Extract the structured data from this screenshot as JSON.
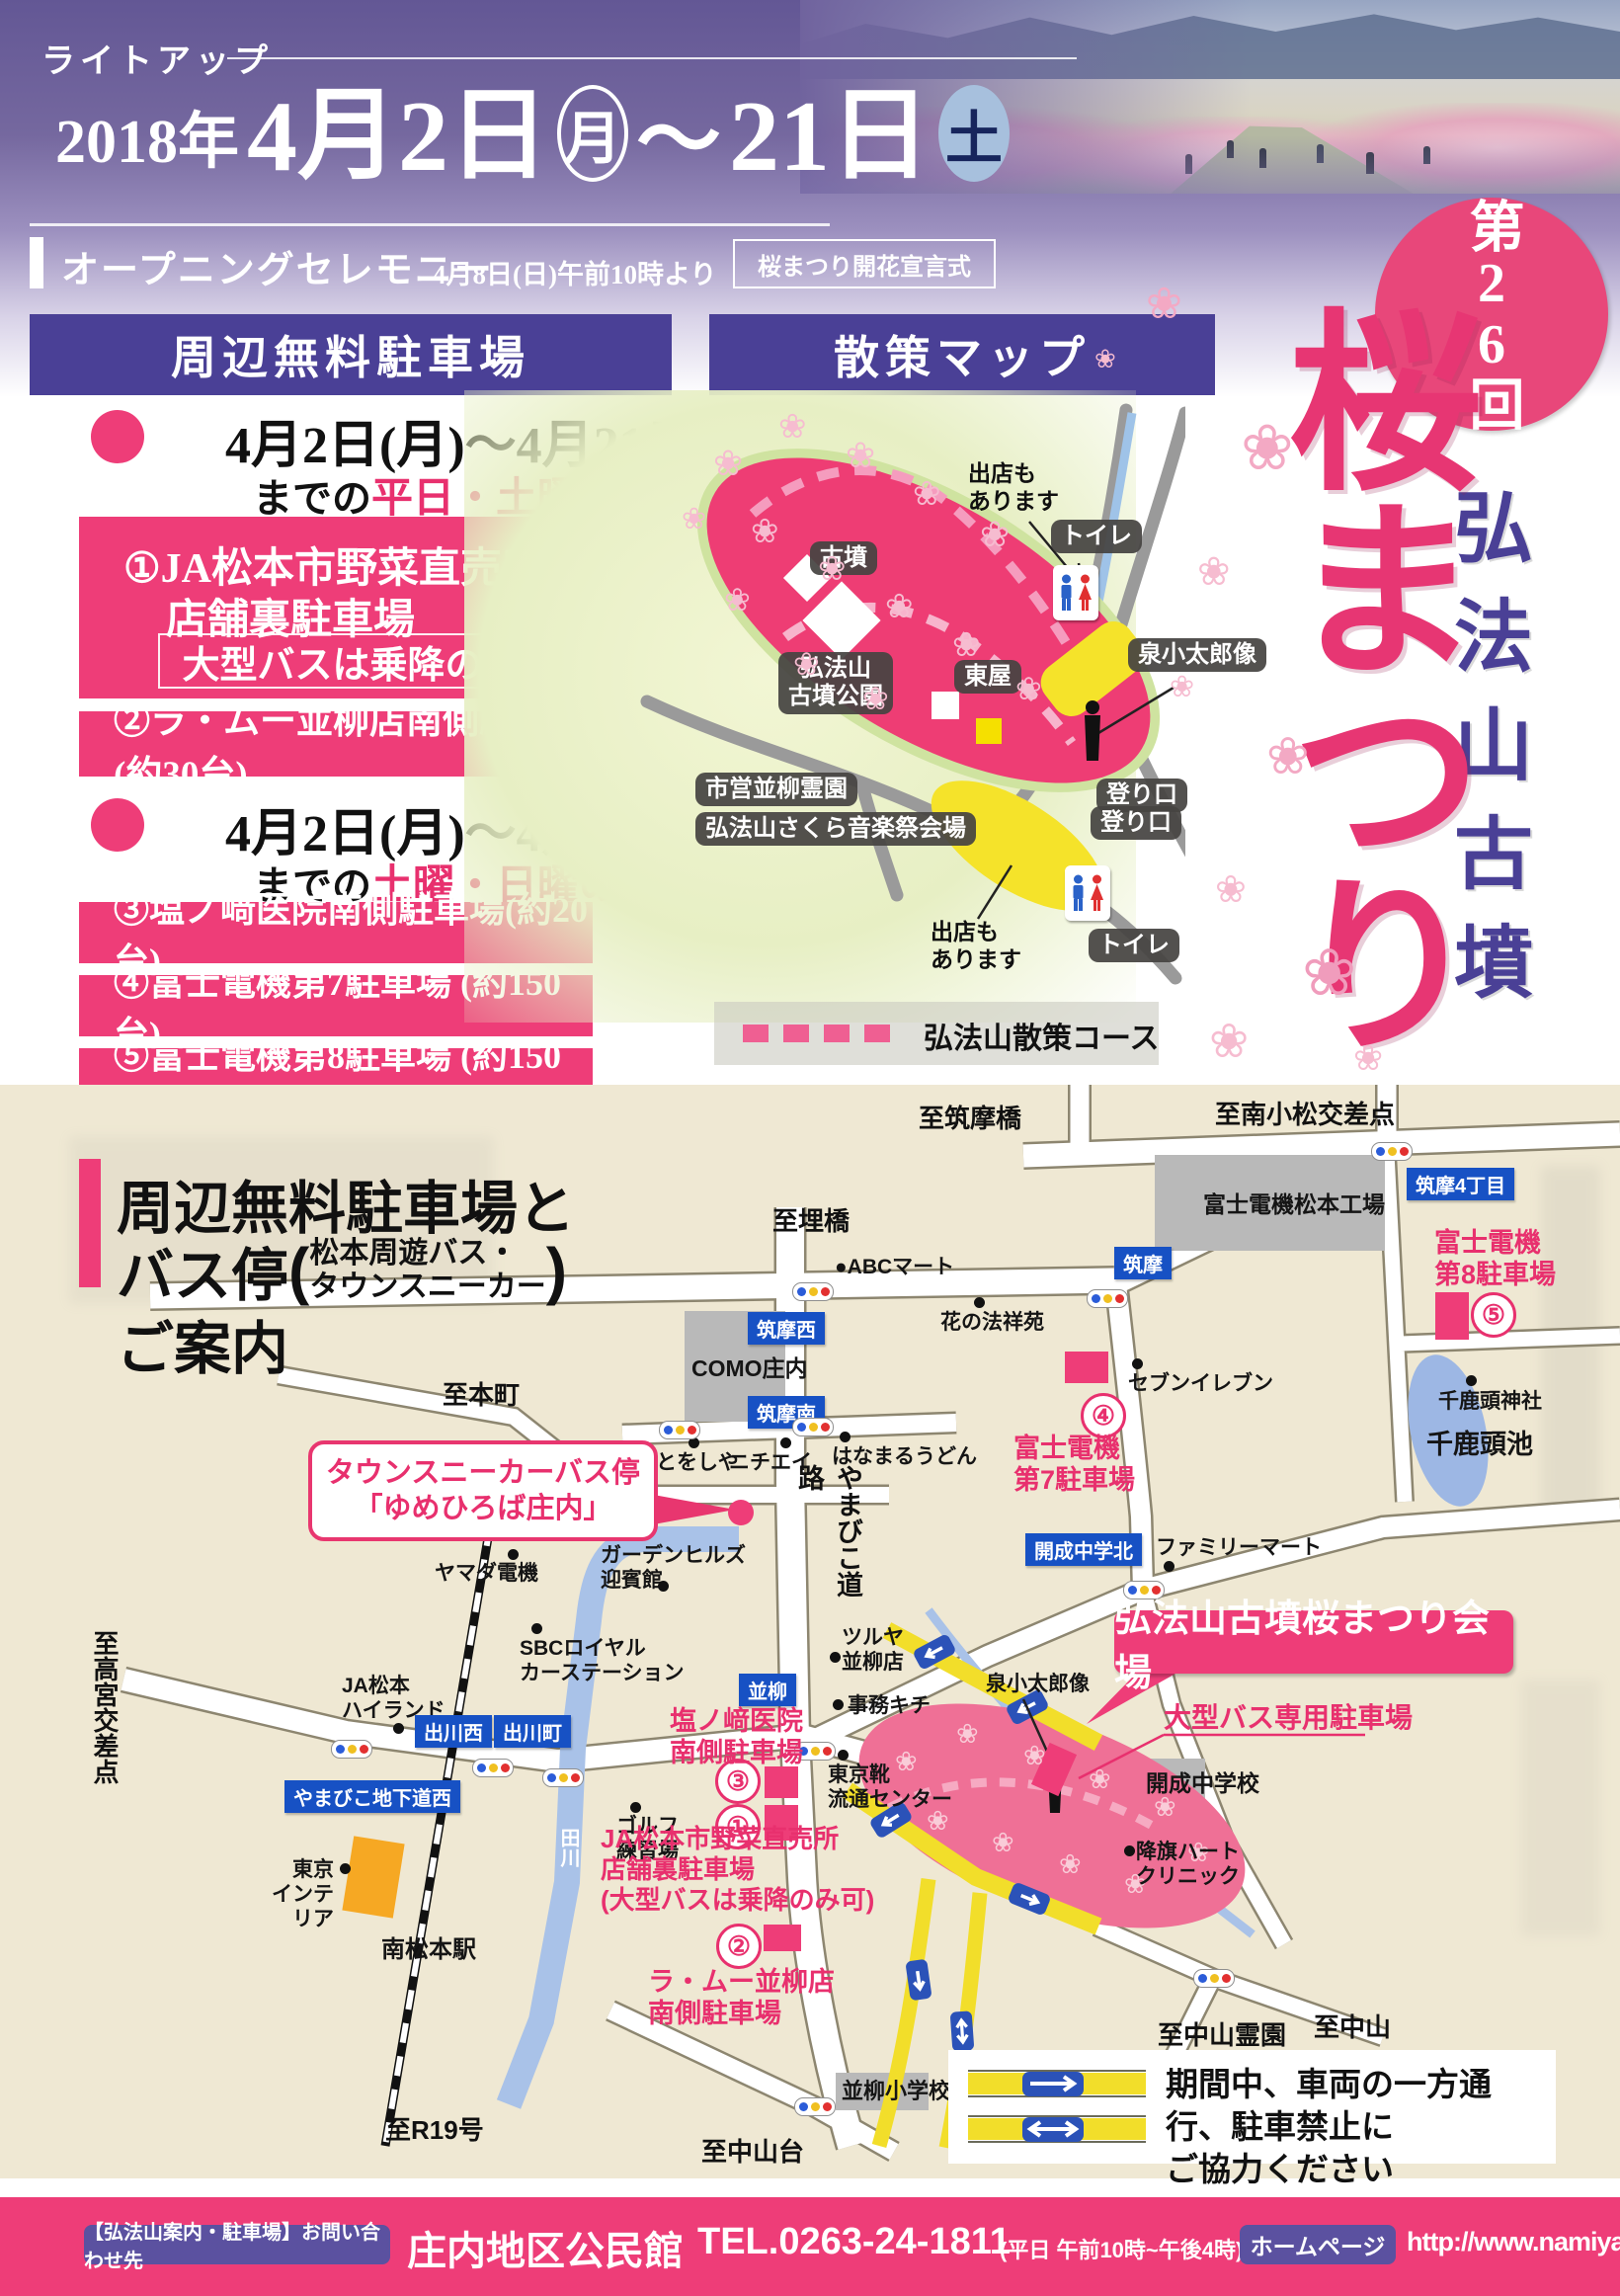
{
  "document": {
    "type": "event-flyer",
    "event": "第26回 弘法山古墳 桜まつり"
  },
  "colors": {
    "pink": "#ee3d78",
    "pink_text": "#e8306e",
    "purple_bar": "#4a4096",
    "blue_sign": "#1751c4",
    "beige": "#efe8d3",
    "yellow_road": "#f2de2a",
    "river": "#a9c2e8"
  },
  "header": {
    "lightup": "ライトアップ",
    "year": "2018年",
    "date_from": "4月2日",
    "dow_from": "月",
    "tilde": "〜",
    "date_to": "21日",
    "dow_to": "土",
    "ceremony_label": "オープニングセレモニー",
    "ceremony_time": "4月8日(日)午前10時より",
    "ceremony_box": "桜まつり開花宣言式"
  },
  "bars": {
    "parking": "周辺無料駐車場",
    "walkmap": "散策マップ"
  },
  "parking": {
    "period1": "4月2日(月)〜4月21日(土)",
    "prefix1": "までの",
    "days1": "平日・土曜・日曜",
    "lot1_line1": "①JA松本市野菜直売所",
    "lot1_line2": "店舗裏駐車場",
    "lot1_note": "大型バスは乗降のみ可",
    "lot2": "②ラ・ムー並柳店南側駐車場(約30台)",
    "period2": "4月2日(月)〜4月21日(土)",
    "prefix2": "までの",
    "days2": "土曜・日曜のみ",
    "lot3": "③塩ノ﨑医院南側駐車場(約20台)",
    "lot4": "④富士電機第7駐車場 (約150台)",
    "lot5": "⑤富士電機第8駐車場 (約150台)"
  },
  "title_art": {
    "round": "第26回",
    "mountain": "弘法山古墳",
    "festival": "桜まつり"
  },
  "walkmap": {
    "chips": [
      "古墳",
      "弘法山\n古墳公園",
      "東屋",
      "トイレ",
      "泉小太郎像",
      "登り口",
      "市営並柳霊園",
      "弘法山さくら音楽祭会場",
      "登り口",
      "トイレ"
    ],
    "notes": [
      "出店も\nあります",
      "出店も\nあります"
    ],
    "legend": "弘法山散策コース"
  },
  "roadmap": {
    "heading": {
      "line1": "周辺無料駐車場と",
      "line2": "バス停",
      "paren1": "松本周遊バス・",
      "paren2": "タウンスニーカー",
      "line3": "ご案内"
    },
    "dest": [
      "至筑摩橋",
      "至南小松交差点",
      "至埋橋",
      "至本町",
      "至高宮交差点",
      "至R19号",
      "至中山台",
      "至中山霊園",
      "至中山"
    ],
    "poi": [
      "●ABCマート",
      "花の法祥苑",
      "COMO庄内",
      "富士電機松本工場",
      "とをしや",
      "ニチエイ",
      "はなまるうどん",
      "セブンイレブン",
      "千鹿頭神社",
      "千鹿頭池",
      "ヤマダ電機",
      "ガーデンヒルズ\n迎賓館",
      "SBCロイヤル\nカーステーション",
      "JA松本\nハイランド",
      "東京\nインテリア",
      "ゴルフ\n練習場",
      "ツルヤ\n並柳店",
      "事務キチ",
      "東京靴\n流通センター",
      "泉小太郎像",
      "ファミリーマート",
      "降旗ハート\nクリニック",
      "開成中学校",
      "並柳小学校",
      "南松本駅"
    ],
    "signs": [
      "筑摩西",
      "筑摩南",
      "筑摩",
      "筑摩4丁目",
      "出川西",
      "出川町",
      "やまびこ地下道西",
      "並柳",
      "開成中学北"
    ],
    "river": "田川",
    "road_vertical": "やまびこ道路",
    "callout_line1": "タウンスニーカーバス停",
    "callout_line2": "「ゆめひろば庄内」",
    "venue_banner": "弘法山古墳桜まつり会場",
    "bus_parking": "大型バス専用駐車場",
    "lots": {
      "n1": "①",
      "t1": "JA松本市野菜直売所\n店舗裏駐車場\n(大型バスは乗降のみ可)",
      "n2": "②",
      "t2": "ラ・ムー並柳店\n南側駐車場",
      "n3": "③",
      "t3": "塩ノ﨑医院\n南側駐車場",
      "n4": "④",
      "t4": "富士電機\n第7駐車場",
      "n5": "⑤",
      "t5": "富士電機\n第8駐車場"
    },
    "legend_note": "期間中、車両の一方通行、駐車禁止に\nご協力ください"
  },
  "footer": {
    "contact_label": "【弘法山案内・駐車場】お問い合わせ先",
    "org": "庄内地区公民館",
    "tel": "TEL.0263-24-1811",
    "hours": "(平日 午前10時~午後4時)",
    "hp_label": "ホームページ",
    "url": "http://www.namiyanagi.com"
  }
}
